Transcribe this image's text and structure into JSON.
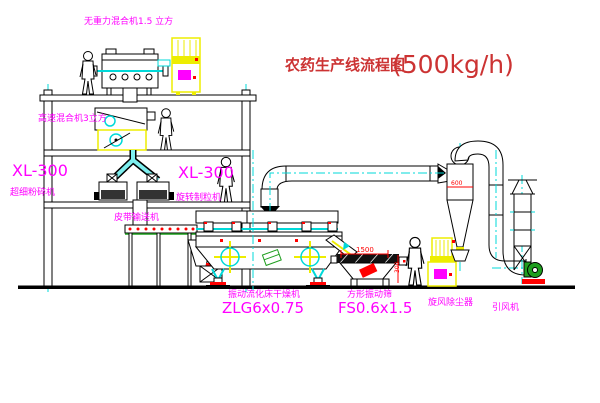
{
  "title": {
    "text": "农药生产线流程图",
    "capacity": "(500kg/h)"
  },
  "equipment_labels": {
    "gravity_mixer": "无重力混合机1.5 立方",
    "high_speed_mixer": "高速混合机3立方",
    "mill_model": "XL-300",
    "mill_name": "超细粉碎机",
    "granulator_model": "XL-300",
    "granulator_name": "旋转制粒机",
    "belt_conveyor": "皮带输送机",
    "dryer_name": "振动流化床干燥机",
    "dryer_model": "ZLG6x0.75",
    "sieve_name": "方形振动筛",
    "sieve_model": "FS0.6x1.5",
    "cyclone": "旋风除尘器",
    "fan": "引风机"
  },
  "dimensions": {
    "sieve_length": "1500",
    "cyclone_dia": "600",
    "sieve_height": "300"
  },
  "colors": {
    "line": "#000000",
    "label": "#ff00ff",
    "title_red": "#cc3333",
    "centerline_cyan": "#00d9d9",
    "cabinet_yellow": "#eded00",
    "dimension_red": "#ff0000",
    "machine_green": "#1f9e1f"
  }
}
